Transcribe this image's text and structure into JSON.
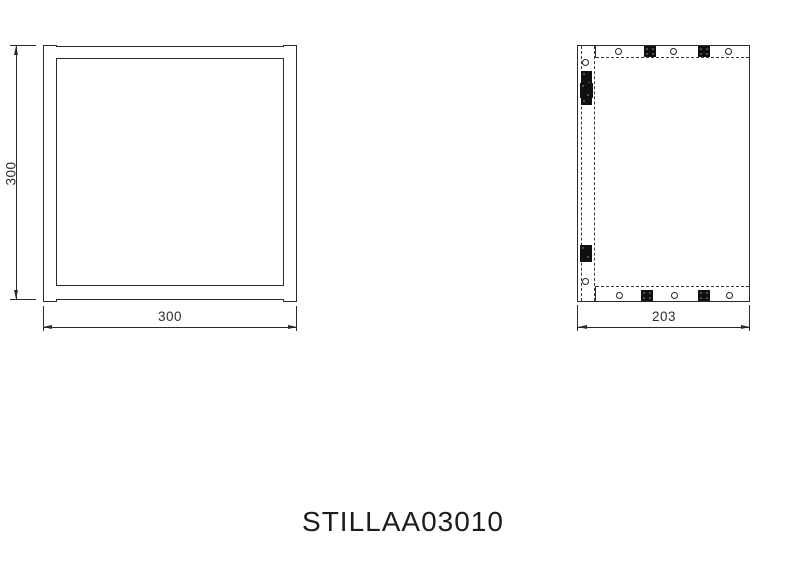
{
  "title": {
    "part_number": "STILLAA03010"
  },
  "front_view": {
    "label": "front-view",
    "height_dim_label": "300",
    "width_dim_label": "300"
  },
  "side_view": {
    "label": "side-view",
    "width_dim_label": "203"
  },
  "colors": {
    "line": "#2a2a2a",
    "fitting": "#101010",
    "background": "#ffffff"
  }
}
